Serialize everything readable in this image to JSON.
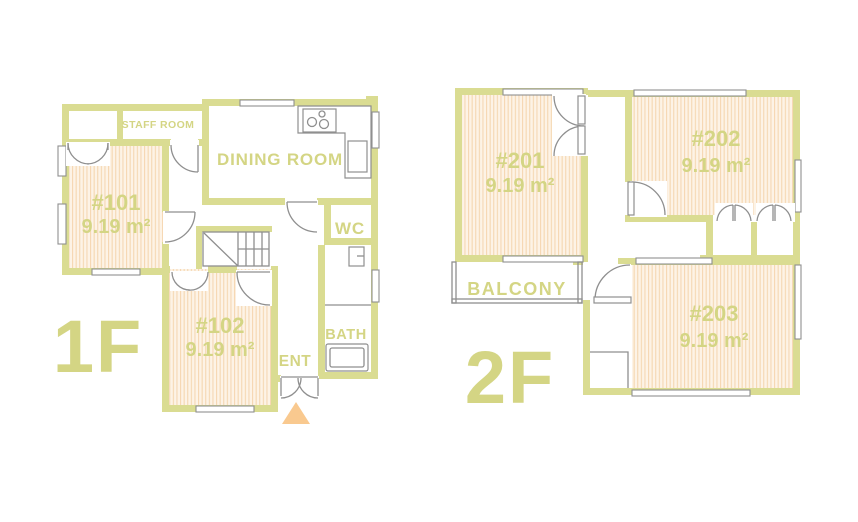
{
  "colors": {
    "wall": "#dadc92",
    "label_text": "#d4d584",
    "room_fill": "#fdf3e6",
    "room_stripe": "#f5d7b2",
    "fixture_line": "#8f8f8f",
    "entrance_arrow": "#f9c98f",
    "background": "#ffffff"
  },
  "floor1": {
    "name": "1F",
    "rooms": [
      {
        "number": "#101",
        "area": "9.19 m²"
      },
      {
        "number": "#102",
        "area": "9.19 m²"
      }
    ],
    "labels": {
      "staff_room": "STAFF ROOM",
      "dining_room": "DINING ROOM",
      "wc": "WC",
      "bath": "BATH",
      "entrance": "ENT"
    }
  },
  "floor2": {
    "name": "2F",
    "rooms": [
      {
        "number": "#201",
        "area": "9.19 m²"
      },
      {
        "number": "#202",
        "area": "9.19 m²"
      },
      {
        "number": "#203",
        "area": "9.19 m²"
      }
    ],
    "labels": {
      "balcony": "BALCONY"
    }
  }
}
